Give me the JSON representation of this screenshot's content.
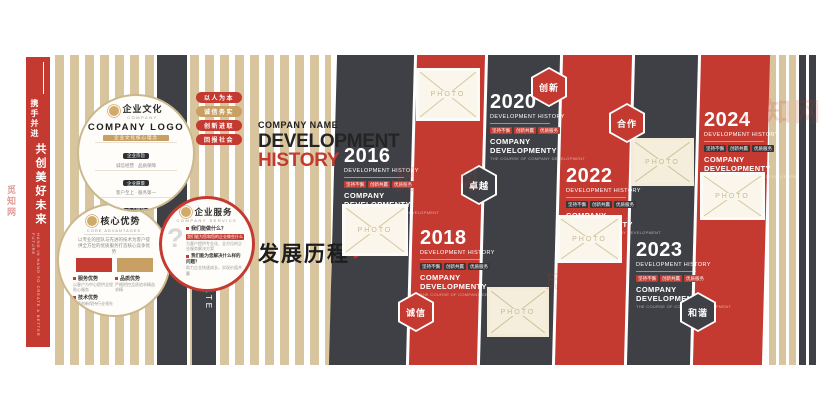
{
  "watermark": {
    "text": "觅知网"
  },
  "colors": {
    "red": "#c43a31",
    "dark": "#3e4045",
    "tan": "#d8c49d",
    "gold": "#c9a063"
  },
  "left_bar": {
    "slogan_small": "携手并进",
    "slogan_large": "共创美好未来",
    "slogan_sub": "HAND IN HAND TO CREATE A BETTER FUTURE"
  },
  "corporate_culture_label": "CORPORATE CULTURE",
  "culture_circle": {
    "logo_title": "企业文化",
    "logo_sub": "COMPANY",
    "title": "COMPANY LOGO",
    "banner": "企业文化核心理念",
    "rows": [
      {
        "label": "企业宗旨",
        "text": "诚信经营 · 品质保障"
      },
      {
        "label": "企业愿景",
        "text": "客户至上 · 服务第一"
      },
      {
        "label": "企业精神",
        "text": "团结拼搏 · 开拓进取"
      },
      {
        "label": "企业理念",
        "text": "追求卓越 · 精益求精"
      },
      {
        "label": "企业目标",
        "text": "合作共赢 · 共创未来"
      }
    ],
    "hexes": [
      "创新",
      "合作",
      "卓越",
      "诚信",
      "和谐"
    ]
  },
  "advantages_circle": {
    "logo_title": "核心优势",
    "logo_sub": "CORE ADVANTAGES",
    "intro": "以专业的团队与先进的技术为客户提供全方位的优质服务打造核心竞争优势",
    "items": [
      {
        "label": "服务优势",
        "text": "以客户为中心提供全程贴心服务"
      },
      {
        "label": "品质优势",
        "text": "严格把控品质追求精益求精"
      },
      {
        "label": "技术优势",
        "text": "持续创新保持行业领先水平"
      }
    ]
  },
  "service_circle": {
    "question_mark": "?",
    "logo_title": "企业服务",
    "logo_sub": "COMPANY SERVICE",
    "q1": "我们能做什么？",
    "banner": "我们能为您和您的企业做些什么",
    "q1_text": "为客户提供专业化、全方位的企业服务解决方案",
    "q2": "我们能为您解决什么样的问题？",
    "q2_text": "助力企业快速成长，实现价值共赢"
  },
  "value_pills": [
    {
      "label": "以人为本"
    },
    {
      "label": "诚信务实"
    },
    {
      "label": "创新进取"
    },
    {
      "label": "回报社会"
    }
  ],
  "header": {
    "company_name": "COMPANY NAME",
    "title_line1": "DEVELOPMENT",
    "title_line2": "HISTORY",
    "cn_title": "发展历程",
    "arrow": "▶"
  },
  "timeline": {
    "photo_label": "PHOTO",
    "years": [
      {
        "year": "2016",
        "subtitle": "DEVELOPMENT HISTORY",
        "tags": [
          "坚持不懈",
          "创新共赢",
          "优质服务"
        ],
        "company1": "COMPANY",
        "company2": "DEVELOPMENTY",
        "fine": "THE COURSE OF COMPANY DEVELOPMENT"
      },
      {
        "year": "2018",
        "subtitle": "DEVELOPMENT HISTORY",
        "tags": [
          "坚持不懈",
          "创新共赢",
          "优质服务"
        ],
        "company1": "COMPANY",
        "company2": "DEVELOPMENTY",
        "fine": "THE COURSE OF COMPANY DEVELOPMENT"
      },
      {
        "year": "2020",
        "subtitle": "DEVELOPMENT HISTORY",
        "tags": [
          "坚持不懈",
          "创新共赢",
          "优质服务"
        ],
        "company1": "COMPANY",
        "company2": "DEVELOPMENTY",
        "fine": "THE COURSE OF COMPANY DEVELOPMENT"
      },
      {
        "year": "2022",
        "subtitle": "DEVELOPMENT HISTORY",
        "tags": [
          "坚持不懈",
          "创新共赢",
          "优质服务"
        ],
        "company1": "COMPANY",
        "company2": "DEVELOPMENTY",
        "fine": "THE COURSE OF COMPANY DEVELOPMENT"
      },
      {
        "year": "2023",
        "subtitle": "DEVELOPMENT HISTORY",
        "tags": [
          "坚持不懈",
          "创新共赢",
          "优质服务"
        ],
        "company1": "COMPANY",
        "company2": "DEVELOPMENTY",
        "fine": "THE COURSE OF COMPANY DEVELOPMENT"
      },
      {
        "year": "2024",
        "subtitle": "DEVELOPMENT HISTORY",
        "tags": [
          "坚持不懈",
          "创新共赢",
          "优质服务"
        ],
        "company1": "COMPANY",
        "company2": "DEVELOPMENTY",
        "fine": "THE COURSE OF COMPANY DEVELOPMENT"
      }
    ],
    "hexagons": [
      {
        "label": "创新"
      },
      {
        "label": "卓越"
      },
      {
        "label": "合作"
      },
      {
        "label": "诚信"
      },
      {
        "label": "和谐"
      }
    ]
  }
}
